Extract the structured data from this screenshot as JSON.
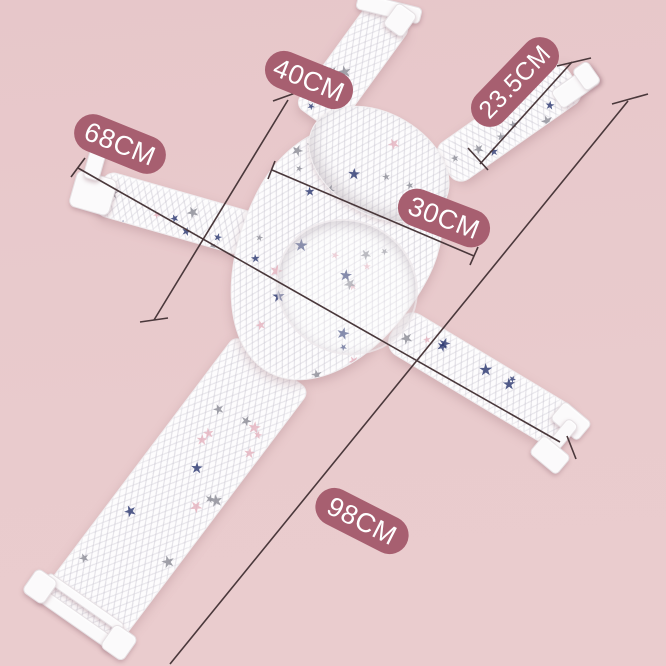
{
  "scene": {
    "subject": "star-print mesh baby bath support net, top view",
    "background_color": "#e8c9cb",
    "fabric_color": "#fdfcfd",
    "star_colors": [
      "#2e3a72",
      "#8d8d97",
      "#e5b3bf"
    ],
    "badge_color": "#a75f70",
    "badge_text_color": "#ffffff",
    "line_color": "#4a383b"
  },
  "measurements": [
    {
      "id": "top-strap-length",
      "label": "40CM"
    },
    {
      "id": "shoulder-strap-length",
      "label": "23.5CM"
    },
    {
      "id": "overall-width",
      "label": "68CM"
    },
    {
      "id": "seat-width",
      "label": "30CM"
    },
    {
      "id": "overall-length",
      "label": "98CM"
    }
  ]
}
